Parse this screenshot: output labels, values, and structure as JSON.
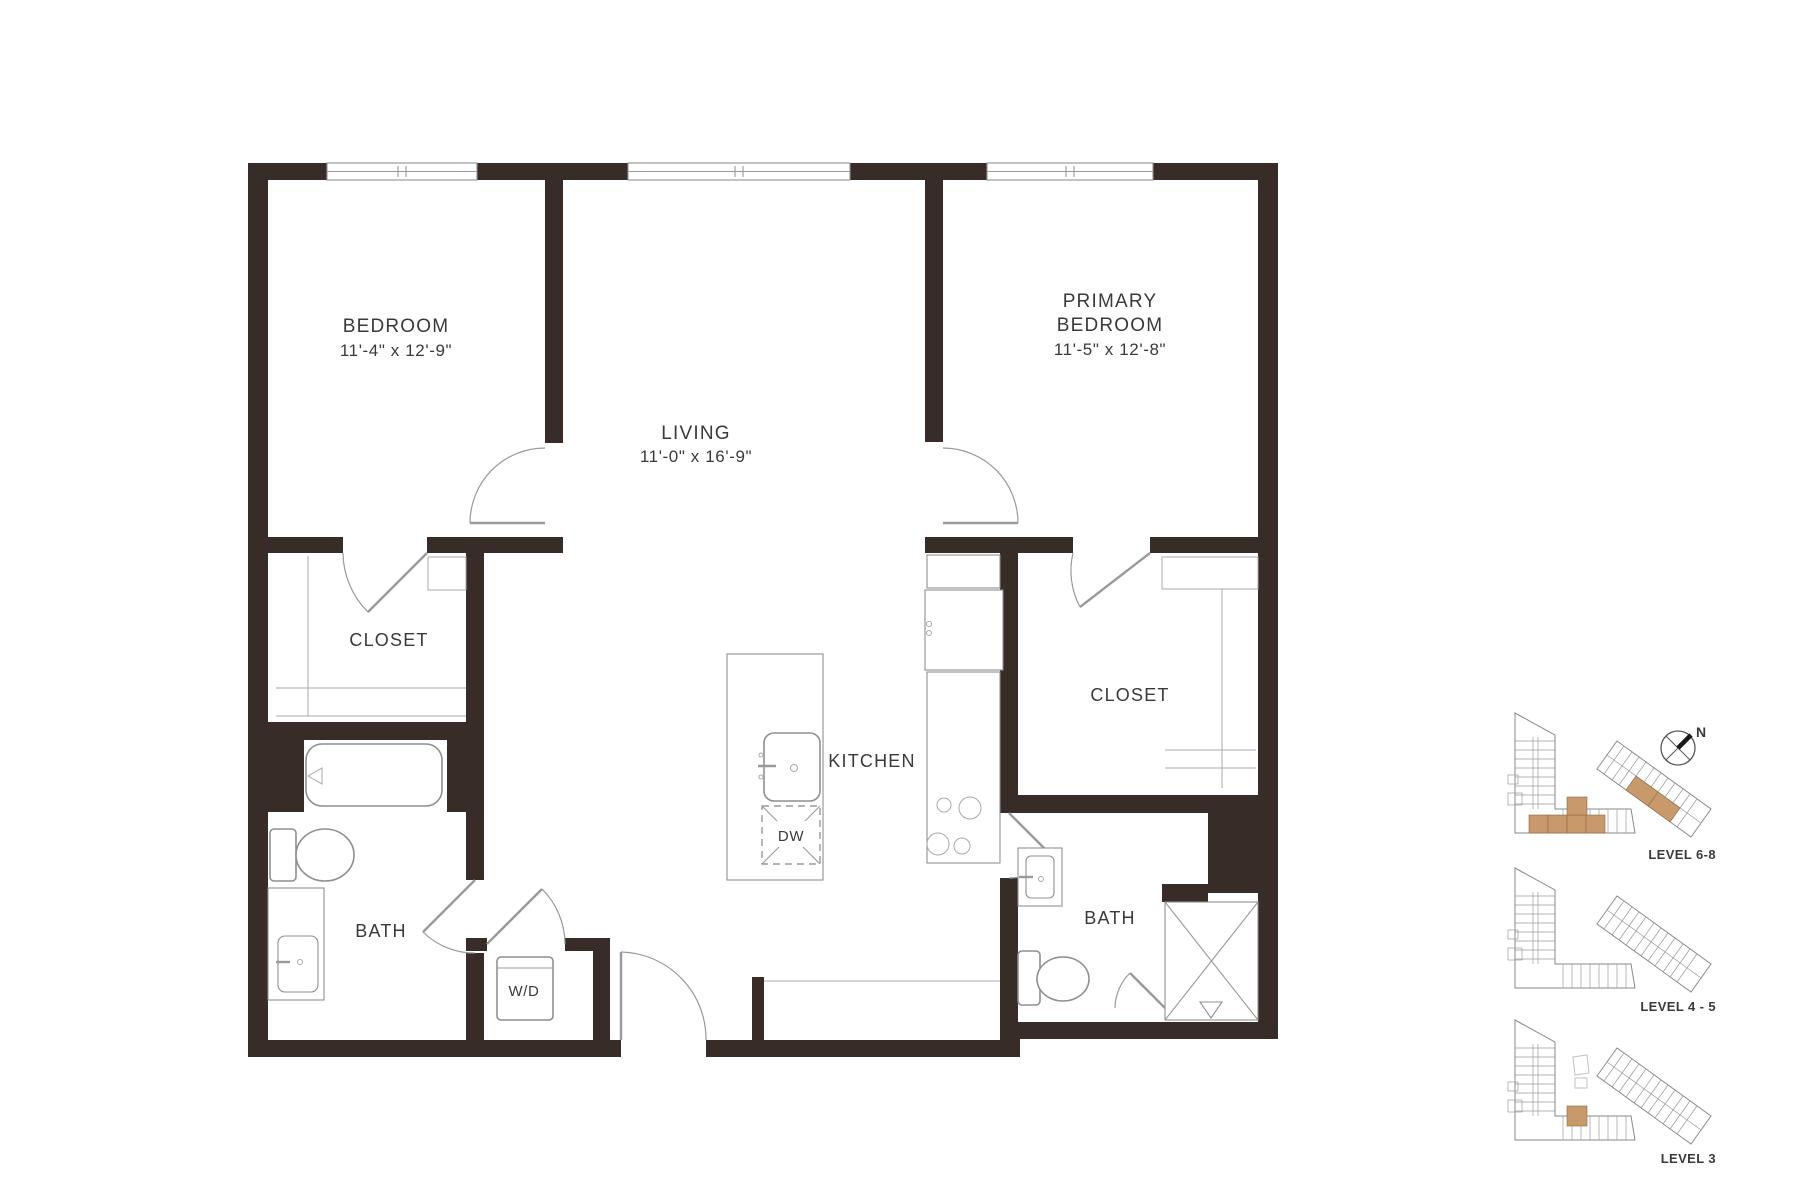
{
  "plan": {
    "rooms": {
      "bedroom": {
        "name": "BEDROOM",
        "dims": "11'-4\" x 12'-9\""
      },
      "living": {
        "name": "LIVING",
        "dims": "11'-0\" x 16'-9\""
      },
      "primary": {
        "line1": "PRIMARY",
        "line2": "BEDROOM",
        "dims": "11'-5\" x 12'-8\""
      },
      "closet_left": {
        "name": "CLOSET"
      },
      "closet_right": {
        "name": "CLOSET"
      },
      "kitchen": {
        "name": "KITCHEN"
      },
      "bath_left": {
        "name": "BATH"
      },
      "bath_right": {
        "name": "BATH"
      },
      "laundry": {
        "name": "W/D"
      },
      "dishwasher": {
        "name": "DW"
      }
    },
    "colors": {
      "wall": "#372c27",
      "line": "#8f8f8f",
      "text": "#3a3a3a",
      "highlight": "#c8996b"
    }
  },
  "keyplan": {
    "compass": "N",
    "levels": [
      {
        "label": "LEVEL 6-8"
      },
      {
        "label": "LEVEL 4 - 5"
      },
      {
        "label": "LEVEL 3"
      }
    ]
  }
}
